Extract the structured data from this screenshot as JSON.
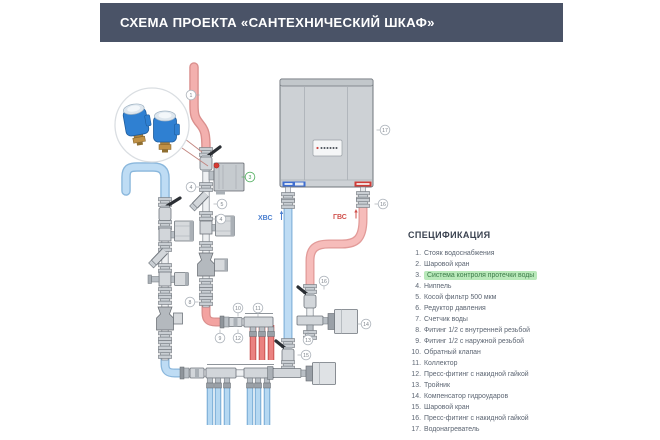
{
  "header": {
    "title": "СХЕМА ПРОЕКТА «САНТЕХНИЧЕСКИЙ ШКАФ»"
  },
  "diagram": {
    "labels": {
      "cold": "ХВС",
      "hot": "ГВС"
    },
    "colors": {
      "cold": "#bedcf4",
      "hot": "#f3b0ae",
      "accent_green": "#5cb469"
    },
    "markers": [
      {
        "n": "1",
        "x": 96,
        "y": 40,
        "lead": "r",
        "highlight": false
      },
      {
        "n": "3",
        "x": 155,
        "y": 122,
        "lead": "l",
        "highlight": true
      },
      {
        "n": "4",
        "x": 96,
        "y": 132,
        "lead": "r",
        "highlight": false
      },
      {
        "n": "5",
        "x": 127,
        "y": 149,
        "lead": "l",
        "highlight": false
      },
      {
        "n": "4",
        "x": 126,
        "y": 164,
        "lead": "l",
        "highlight": false
      },
      {
        "n": "8",
        "x": 95,
        "y": 247,
        "lead": "r",
        "highlight": false
      },
      {
        "n": "9",
        "x": 125,
        "y": 283,
        "lead": "u",
        "highlight": false
      },
      {
        "n": "10",
        "x": 143,
        "y": 253,
        "lead": "d",
        "highlight": false
      },
      {
        "n": "11",
        "x": 163,
        "y": 253,
        "lead": "d",
        "highlight": false
      },
      {
        "n": "12",
        "x": 143,
        "y": 283,
        "lead": "u",
        "highlight": false
      },
      {
        "n": "13",
        "x": 213,
        "y": 285,
        "lead": "u",
        "highlight": false
      },
      {
        "n": "14",
        "x": 271,
        "y": 269,
        "lead": "l",
        "highlight": false
      },
      {
        "n": "15",
        "x": 211,
        "y": 300,
        "lead": "l",
        "highlight": false
      },
      {
        "n": "16",
        "x": 288,
        "y": 149,
        "lead": "l",
        "highlight": false
      },
      {
        "n": "16",
        "x": 229,
        "y": 226,
        "lead": "d",
        "highlight": false
      },
      {
        "n": "17",
        "x": 290,
        "y": 75,
        "lead": "l",
        "highlight": false
      }
    ]
  },
  "spec": {
    "title": "СПЕЦИФИКАЦИЯ",
    "items": [
      {
        "n": "1.",
        "label": "Стояк водоснабжения",
        "highlight": false
      },
      {
        "n": "2.",
        "label": "Шаровой кран",
        "highlight": false
      },
      {
        "n": "3.",
        "label": "Система контроля протечки воды",
        "highlight": true
      },
      {
        "n": "4.",
        "label": "Ниппель",
        "highlight": false
      },
      {
        "n": "5.",
        "label": "Косой фильтр 500 мкм",
        "highlight": false
      },
      {
        "n": "6.",
        "label": "Редуктор давления",
        "highlight": false
      },
      {
        "n": "7.",
        "label": "Счетчик воды",
        "highlight": false
      },
      {
        "n": "8.",
        "label": "Фитинг 1/2 с внутренней резьбой",
        "highlight": false
      },
      {
        "n": "9.",
        "label": "Фитинг 1/2 с наружной резьбой",
        "highlight": false
      },
      {
        "n": "10.",
        "label": "Обратный клапан",
        "highlight": false
      },
      {
        "n": "11.",
        "label": "Коллектор",
        "highlight": false
      },
      {
        "n": "12.",
        "label": "Пресс-фитинг с накидной гайкой",
        "highlight": false
      },
      {
        "n": "13.",
        "label": "Тройник",
        "highlight": false
      },
      {
        "n": "14.",
        "label": "Компенсатор гидроударов",
        "highlight": false
      },
      {
        "n": "15.",
        "label": "Шаровой кран",
        "highlight": false
      },
      {
        "n": "16.",
        "label": "Пресс-фитинг с накидной гайкой",
        "highlight": false
      },
      {
        "n": "17.",
        "label": "Водонагреватель",
        "highlight": false
      }
    ]
  }
}
